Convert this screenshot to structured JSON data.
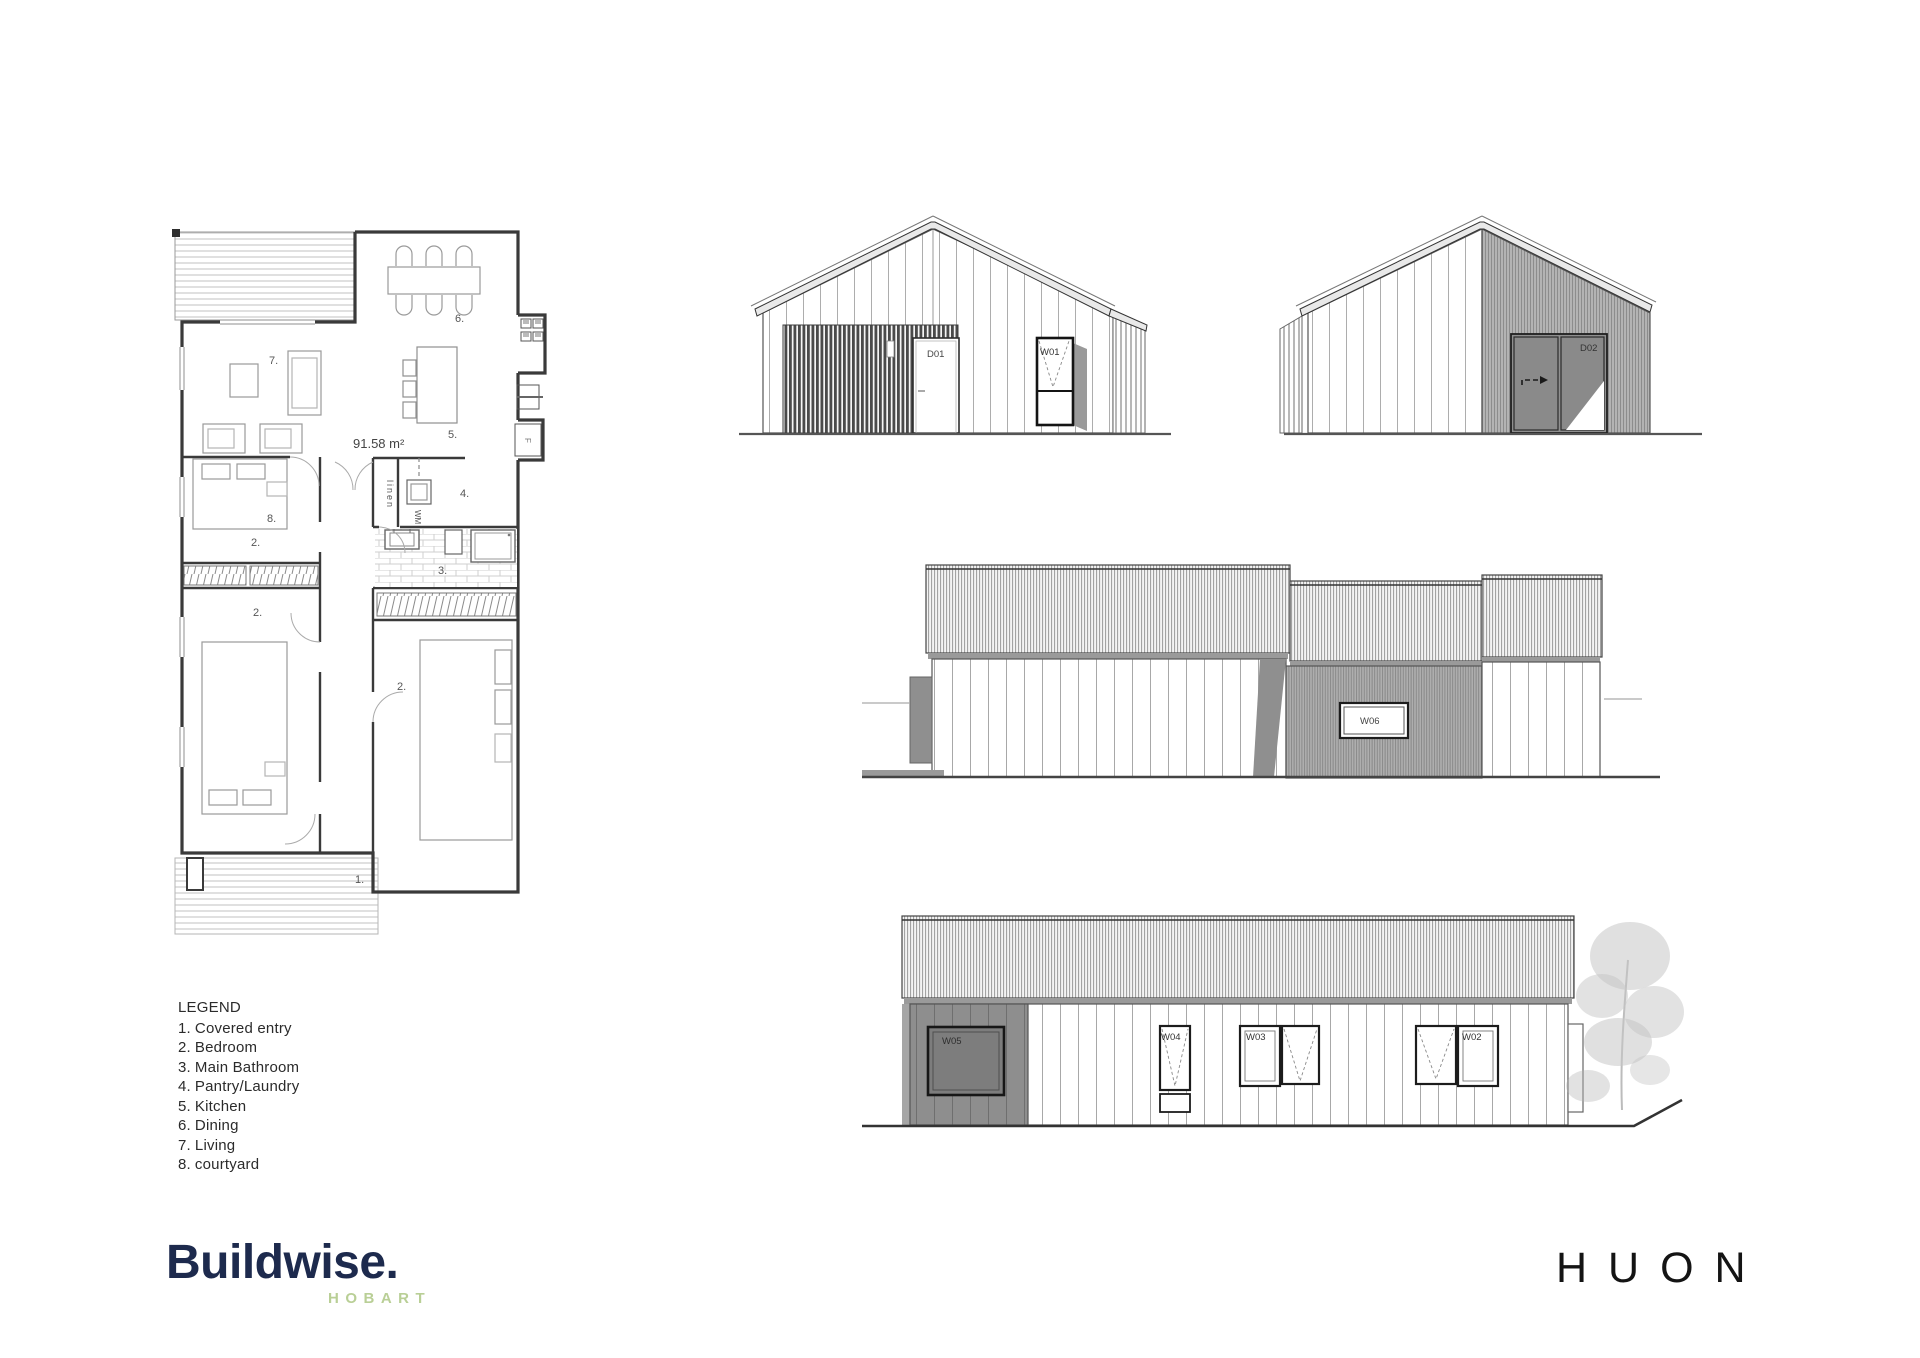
{
  "brand": {
    "wordmark": "Buildwise.",
    "sub": "HOBART",
    "wordmark_color": "#1d2a4d",
    "sub_color": "#b9cf96"
  },
  "sheet": {
    "title": "HUON"
  },
  "legend": {
    "title": "LEGEND",
    "items": [
      {
        "num": "1.",
        "label": "Covered entry"
      },
      {
        "num": "2.",
        "label": "Bedroom"
      },
      {
        "num": "3.",
        "label": "Main Bathroom"
      },
      {
        "num": "4.",
        "label": "Pantry/Laundry"
      },
      {
        "num": "5.",
        "label": "Kitchen"
      },
      {
        "num": "6.",
        "label": "Dining"
      },
      {
        "num": "7.",
        "label": "Living"
      },
      {
        "num": "8.",
        "label": "courtyard"
      }
    ]
  },
  "floor_plan": {
    "area": "91.58 m²",
    "labels": {
      "courtyard": "8.",
      "living": "7.",
      "dining": "6.",
      "kitchen": "5.",
      "pantry": "4.",
      "bathroom": "3.",
      "bedroom1": "2.",
      "bedroom2": "2.",
      "bedroom3": "2.",
      "entry": "1."
    },
    "linen": "linen",
    "washing_machine": "WM",
    "fridge": "F"
  },
  "elevations": {
    "front": {
      "door": "D01",
      "window": "W01"
    },
    "rear": {
      "door": "D02"
    },
    "side": {
      "window": "W06"
    },
    "street": {
      "w05": "W05",
      "w04": "W04",
      "w03": "W03",
      "w02": "W02"
    }
  }
}
